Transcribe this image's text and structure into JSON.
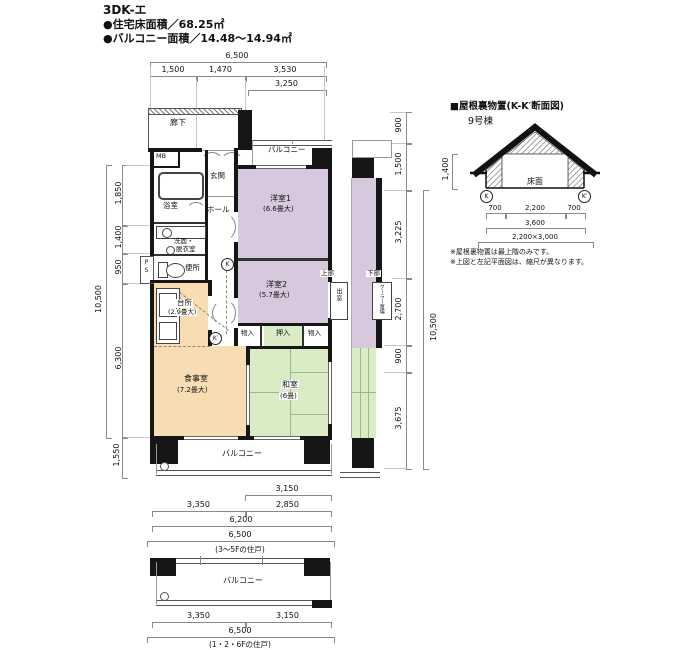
{
  "header": {
    "title": "3DK-エ",
    "line1": "●住宅床面積／68.25㎡",
    "line2": "●バルコニー面積／14.48～14.94㎡"
  },
  "plan": {
    "rooms": {
      "roka": "廊下",
      "mb": "MB",
      "balcony_top": "バルコニー",
      "genkan": "玄関",
      "yokushitsu": "浴室",
      "hall": "ホール",
      "senmen1": "洗面・",
      "senmen2": "脱衣室",
      "ps": "PS",
      "benjo": "便所",
      "daidokoro": "台所",
      "daidokoro_size": "(2.9畳大)",
      "yoshitsu1": "洋室1",
      "yoshitsu1_size": "(6.6畳大)",
      "yoshitsu2": "洋室2",
      "yoshitsu2_size": "(5.7畳大)",
      "jobu": "上部",
      "demado": "出窓",
      "mono_left": "物入",
      "oshiire": "押入",
      "mono_right": "物入",
      "shokujishitsu": "食事室",
      "shokujishitsu_size": "(7.2畳大)",
      "washitsu": "和室",
      "washitsu_size": "(6畳)",
      "balcony_bottom": "バルコニー",
      "k": "K",
      "k_prime": "K′"
    },
    "fragment": {
      "kabu": "下部",
      "cooler": "クーラー置場"
    },
    "dims": {
      "top_total": "6,500",
      "top_segs": [
        "1,500",
        "1,470",
        "3,530"
      ],
      "top_sub": "3,250",
      "left_total": "10,500",
      "left_segs": [
        "1,850",
        "1,400",
        "950",
        "6,300"
      ],
      "left_bottom": "1,550",
      "right_segs_upper": [
        "900",
        "1,500"
      ],
      "right_segs": [
        "3,225",
        "2,700",
        "900",
        "3,675"
      ],
      "right_total": "10,500",
      "bottom_sub": "3,150",
      "bottom_segs": [
        "3,350",
        "2,850"
      ],
      "bottom_mid": "6,200",
      "bottom_total": "6,500",
      "caption": "(3～5Fの住戸)"
    }
  },
  "lower_plan": {
    "balcony": "バルコニー",
    "dims": [
      "3,350",
      "3,150"
    ],
    "total": "6,500",
    "caption": "(1・2・6Fの住戸)"
  },
  "section": {
    "title": "■屋根裏物置(K-K′断面図)",
    "building": "9号棟",
    "floor": "床面",
    "height": "1,400",
    "k": "K",
    "k_prime": "K′",
    "dims": [
      "700",
      "2,200",
      "700"
    ],
    "width_inner": "3,600",
    "size": "2,200×3,000",
    "note1": "※屋根裏物置は最上階のみです。",
    "note2": "※上図と左記平面図は、縮尺が異なります。"
  },
  "colors": {
    "room_purple": "#d7c8de",
    "room_orange": "#f8ddb2",
    "room_green": "#daecc6",
    "wall_black": "#161616"
  }
}
